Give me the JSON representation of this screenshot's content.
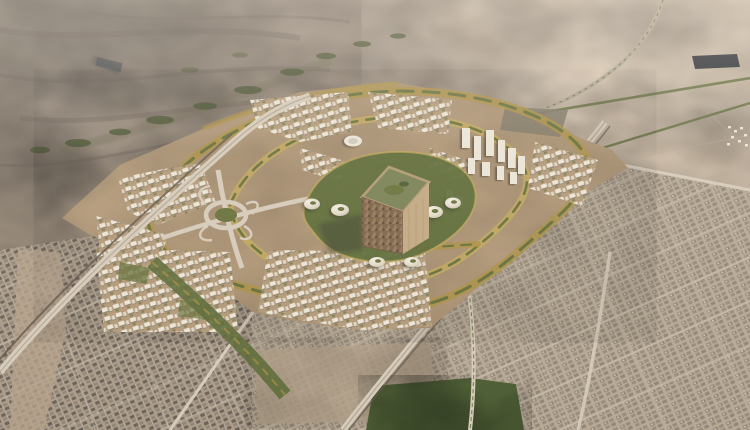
{
  "scene": {
    "title": "Aerial desert-city render: giant cube tower masterplan surrounded by existing low-rise city and open desert",
    "landmarks": [
      {
        "id": "desert-plain",
        "label": "Open desert plain"
      },
      {
        "id": "rocky-wadi",
        "label": "Rocky desert with green wadi vegetation"
      },
      {
        "id": "solar-farm",
        "label": "Dark panel field in desert"
      },
      {
        "id": "old-city",
        "label": "Existing dense low-rise city fabric"
      },
      {
        "id": "new-district",
        "label": "New masterplan district with terraced golden bands"
      },
      {
        "id": "mukaab-cube",
        "label": "Monumental cube skyscraper"
      },
      {
        "id": "dome-pavilions",
        "label": "White shell-dome pavilions around cube"
      },
      {
        "id": "stadium",
        "label": "White oval venue"
      },
      {
        "id": "interchange",
        "label": "Highway interchange with loop ramps"
      },
      {
        "id": "se-highway",
        "label": "Diagonal highway through city"
      },
      {
        "id": "west-corridor",
        "label": "Western road and rail corridor"
      },
      {
        "id": "city-park",
        "label": "Dark green urban park"
      },
      {
        "id": "desert-roads",
        "label": "Tree-lined desert roads"
      },
      {
        "id": "white-towers",
        "label": "New white tower cluster"
      },
      {
        "id": "green-spine",
        "label": "Diagonal green linear park"
      }
    ]
  },
  "palette": {
    "sand-base": "#b9a68f",
    "desert-nw": "#8b7f73",
    "desert-nw-dark": "#635a52",
    "desert-ne": "#cab7a3",
    "desert-ne-light": "#d8c7b3",
    "dev-ground": "#b29878",
    "city-base": "#ab9b88",
    "city-base2": "#b7a894",
    "city-dark": "#6b6359",
    "city-mid": "#8f8577",
    "city-light": "#c7bcab",
    "white-bldg": "#ebe5d7",
    "white-bldg2": "#ddd5c4",
    "green-dark": "#46522f",
    "green-mid": "#66713c",
    "green-belt": "#5c6a38",
    "gold": "#aa8e41",
    "gold-light": "#c2a75a",
    "road-light": "#d6cbba",
    "road-mid": "#b3a895",
    "rail-dark": "#60564b",
    "cube-left": "#7c644a",
    "cube-left2": "#94785b",
    "cube-right": "#c2a883",
    "cube-top": "#798055",
    "cube-frame": "#b19973",
    "solar": "#2c2f36",
    "park": "#4c5c34",
    "dirt": "#b5a28b",
    "shadow-dark": "#3c4130",
    "haze": "#f4ebdd"
  }
}
